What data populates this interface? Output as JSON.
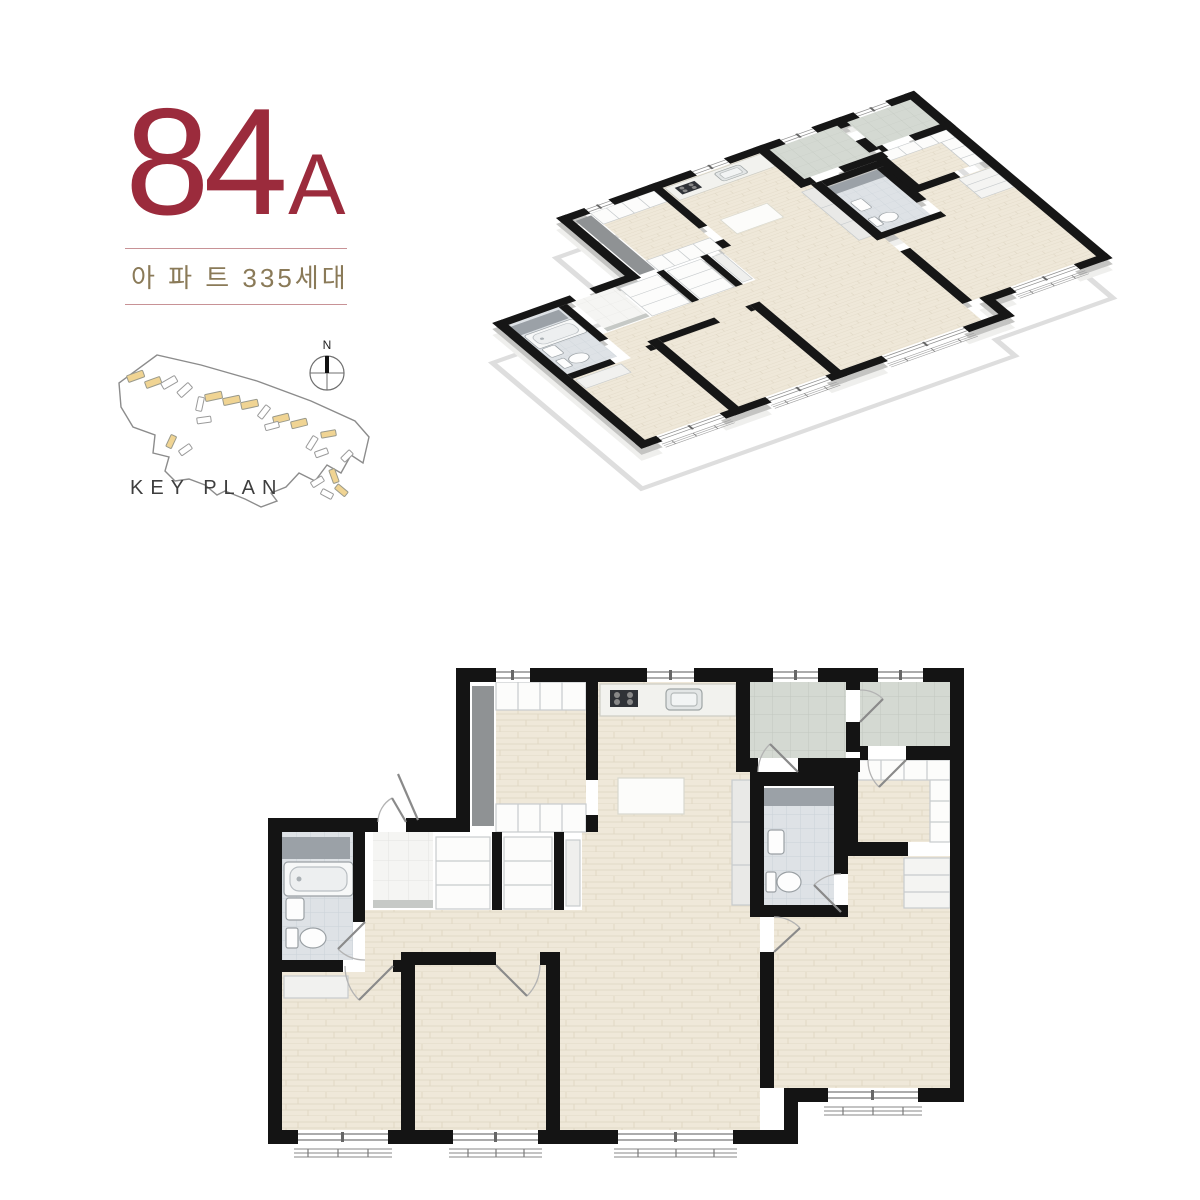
{
  "unit": {
    "number": "84",
    "letter": "A",
    "subtitle": "아 파 트 335세대"
  },
  "key_plan": {
    "label": "KEY PLAN",
    "compass_label": "N"
  },
  "colors": {
    "accent_red": "#9B2B3C",
    "subtitle_brown": "#8A7A58",
    "divider_pink": "#C89296",
    "wall_black": "#141414",
    "wood_floor": "#EFE8D9",
    "bath_tile": "#DEE2E6",
    "utility_tile": "#D4D9D2",
    "entry_tile": "#F5F5F3",
    "keyplan_highlight": "#F0D493",
    "keyplan_outline": "#8C8C8C"
  }
}
